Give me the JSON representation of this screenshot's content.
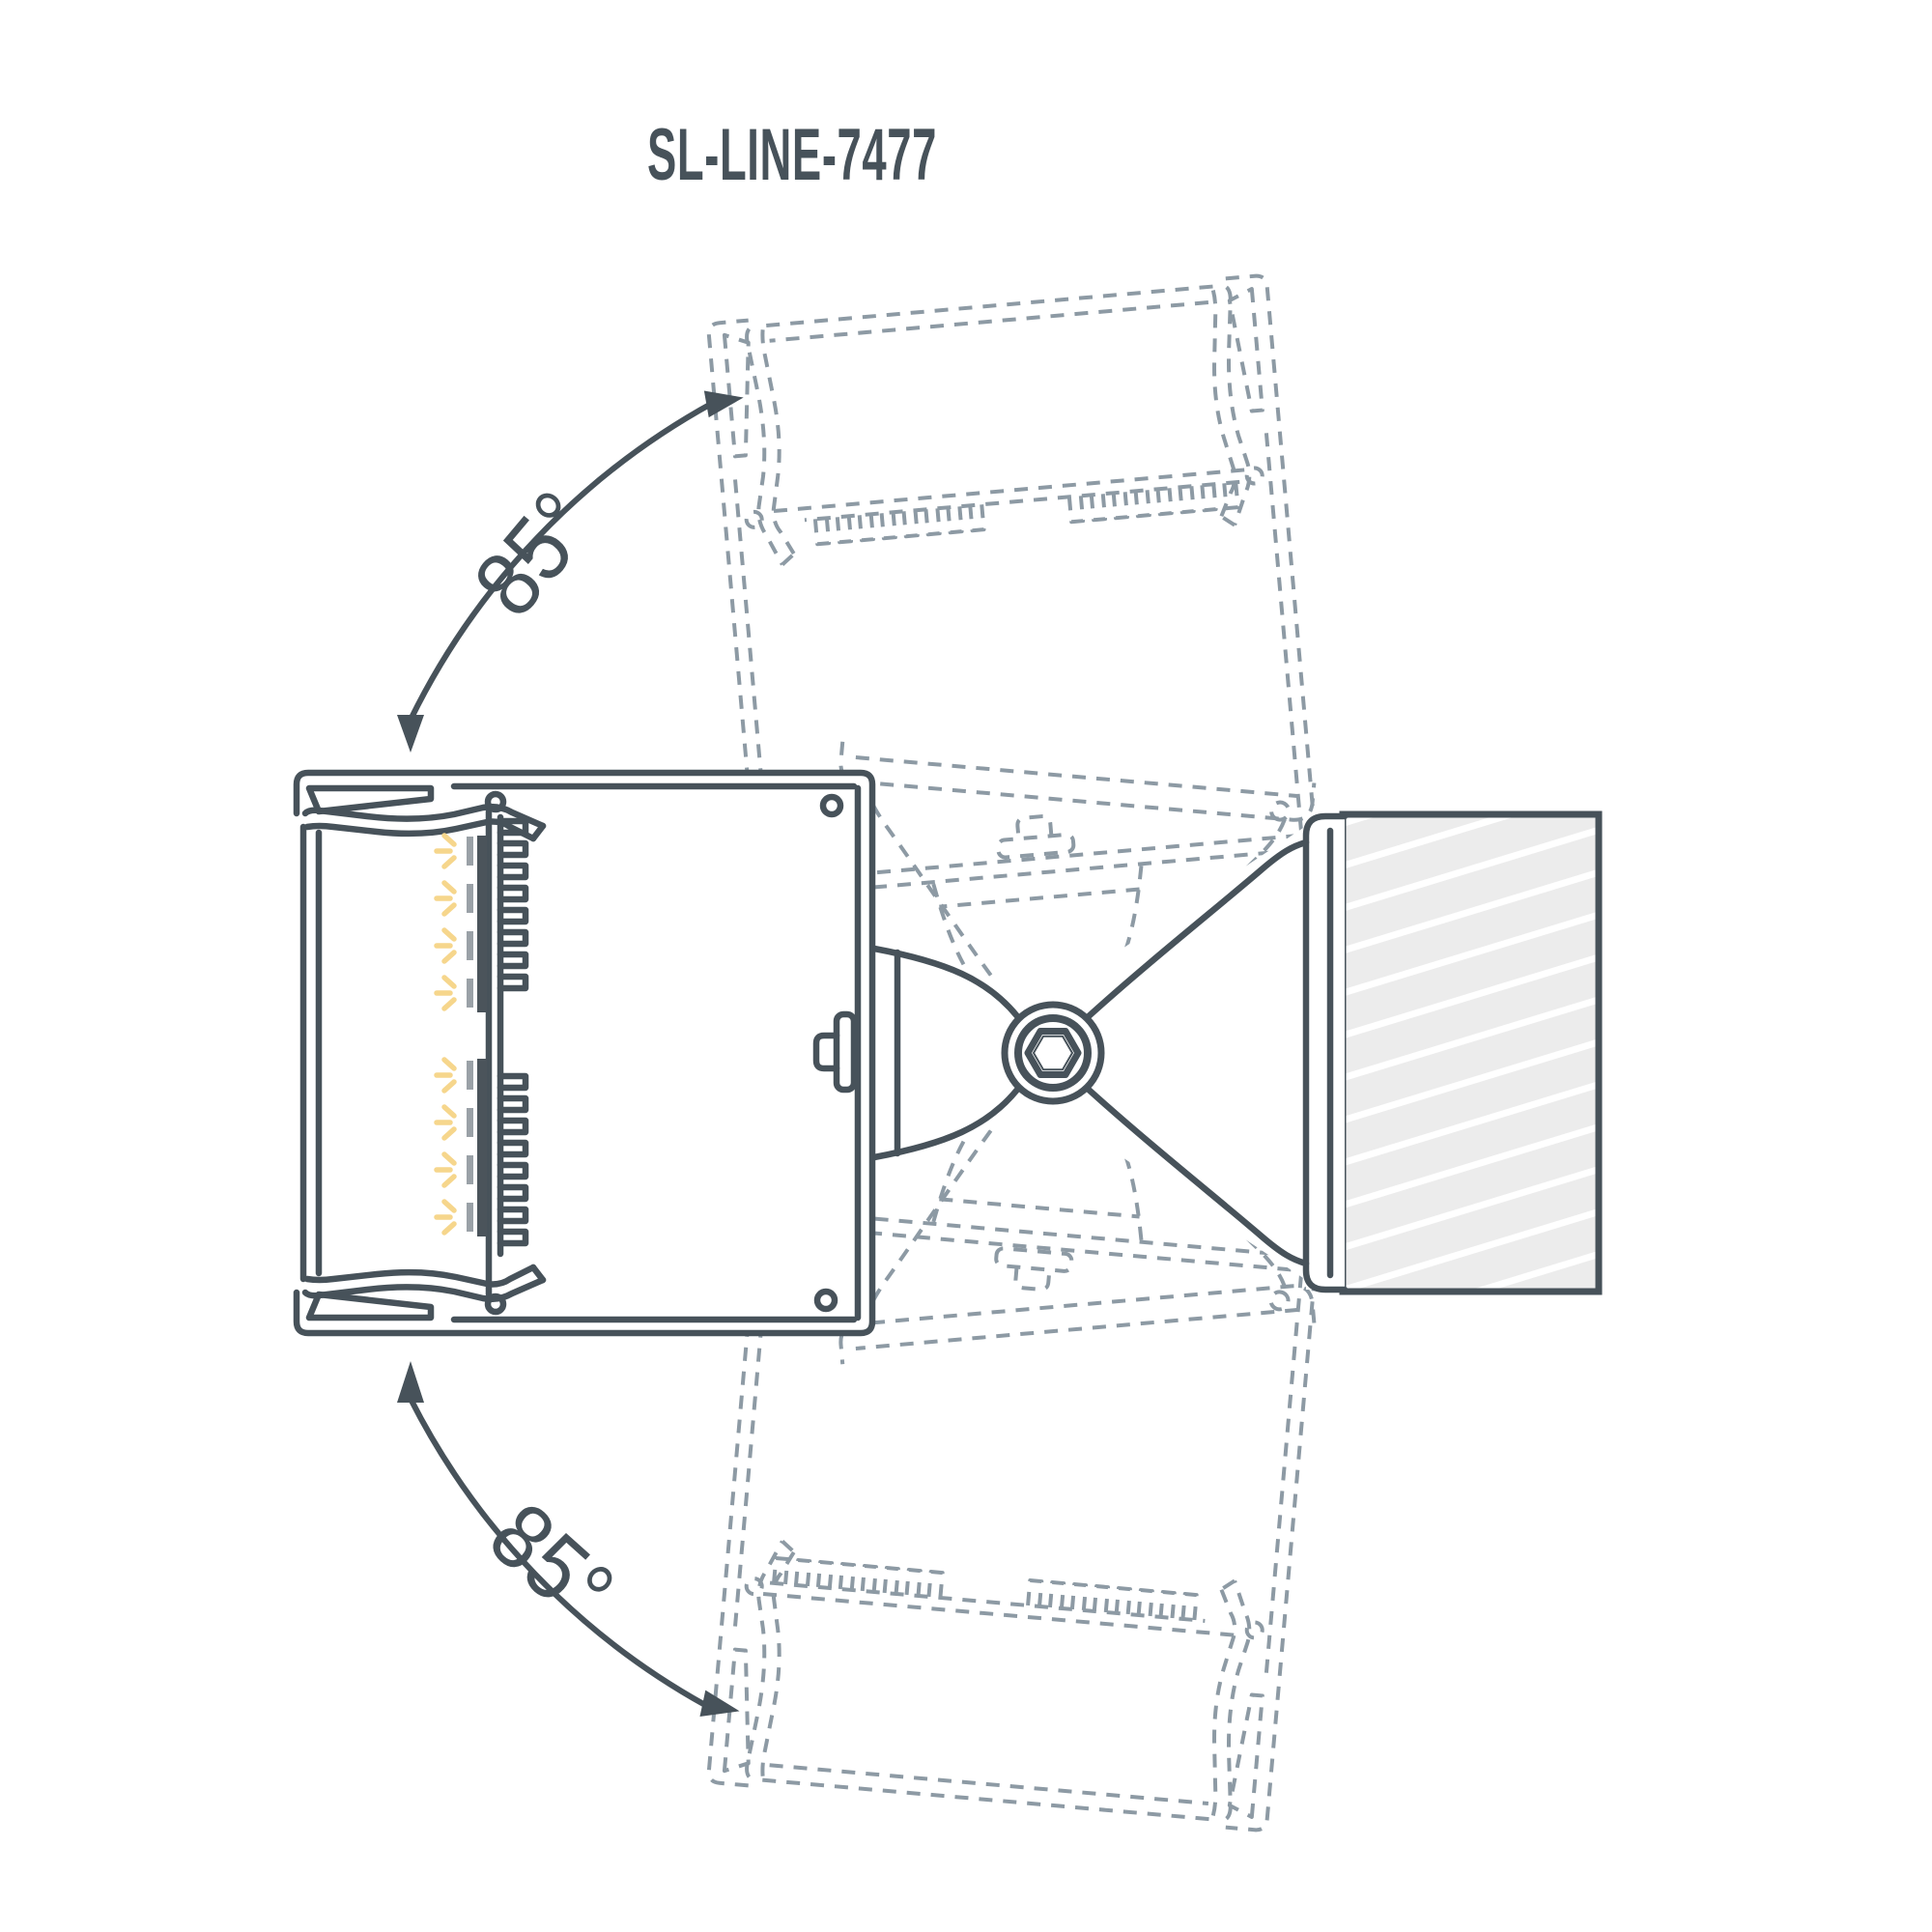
{
  "title": "SL-LINE-7477",
  "annotations": {
    "top_angle": "85°",
    "bottom_angle": "85°"
  },
  "colors": {
    "line": "#47525a",
    "ghost": "#8d9aa4",
    "led_ray": "#f6d68c",
    "led_chip": "#9aa1a7",
    "pcb": "#4b545b",
    "wall_fill": "#ececec",
    "hatch": "#ffffff",
    "background": "#ffffff"
  }
}
